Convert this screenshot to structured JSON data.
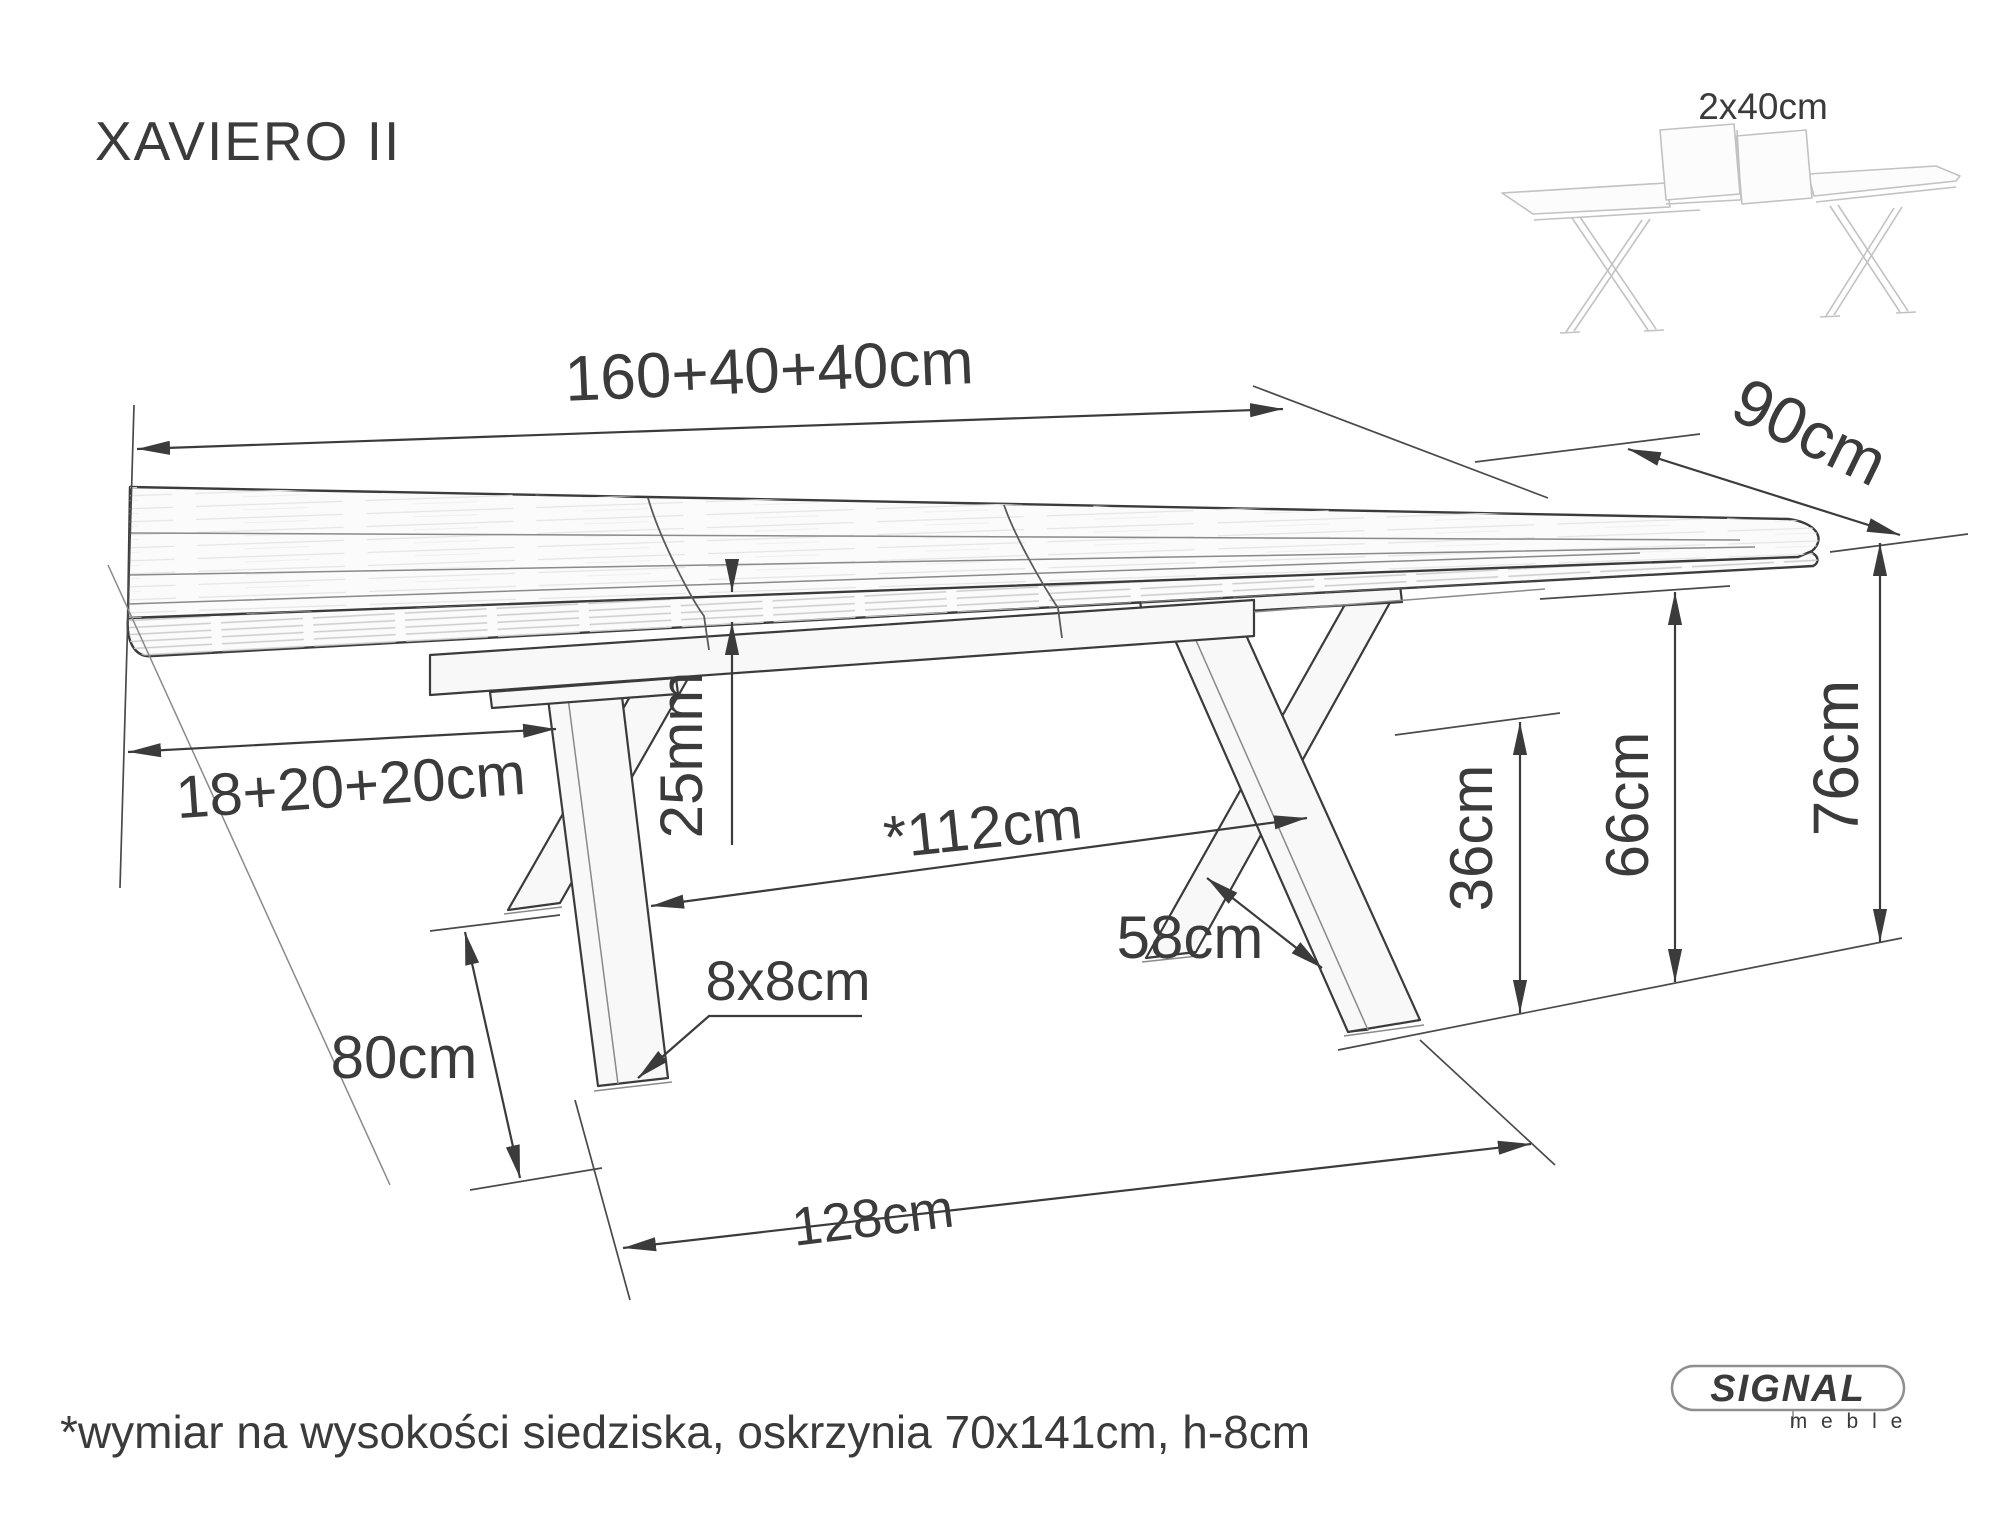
{
  "page": {
    "title": "XAVIERO II",
    "footnote": "*wymiar na wysokości siedziska, oskrzynia 70x141cm, h-8cm"
  },
  "thumbnail": {
    "extension_label": "2x40cm",
    "extension_color": "#c51414"
  },
  "dimensions": {
    "length": "160+40+40cm",
    "depth": "90cm",
    "left_sections": "18+20+20cm",
    "top_thickness": "25mm",
    "inner_clearance": "*112cm",
    "leg_spread": "58cm",
    "cross_height": "36cm",
    "under_frame_height": "66cm",
    "total_height": "76cm",
    "leg_length": "80cm",
    "leg_profile": "8x8cm",
    "base_span": "128cm"
  },
  "brand": {
    "name": "SIGNAL",
    "subtitle": "m e b l e"
  },
  "colors": {
    "line": "#3b3b3b",
    "light_line": "#c2c2c2",
    "footnote_gray": "#a8a8a8",
    "brand_gray": "#8f8f8f",
    "accent_red": "#c51414",
    "background": "#ffffff"
  }
}
